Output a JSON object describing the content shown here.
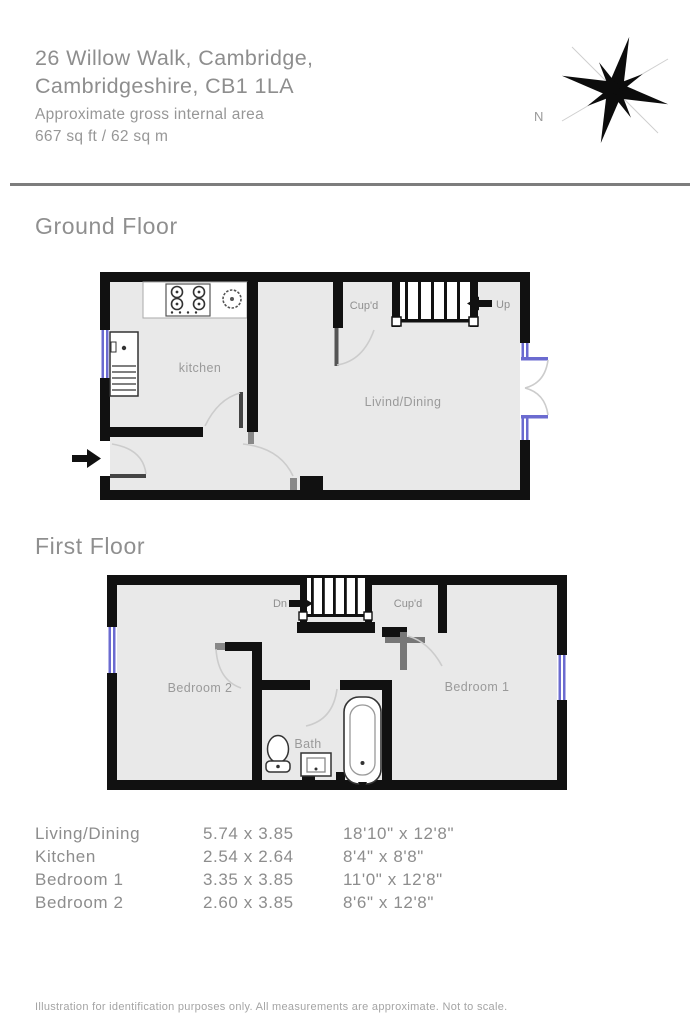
{
  "header": {
    "address_line1": "26 Willow Walk, Cambridge,",
    "address_line2": "Cambridgeshire, CB1 1LA",
    "area_line1": "Approximate gross internal area",
    "area_line2": "667 sq ft / 62 sq m"
  },
  "compass": {
    "north_label": "N"
  },
  "ground_floor": {
    "title": "Ground Floor",
    "labels": {
      "kitchen": "kitchen",
      "living": "Livind/Dining",
      "cupboard": "Cup'd",
      "stairs": "Up"
    }
  },
  "first_floor": {
    "title": "First Floor",
    "labels": {
      "bedroom2": "Bedroom 2",
      "bedroom1": "Bedroom 1",
      "bath": "Bath",
      "cupboard": "Cup'd",
      "stairs": "Dn"
    }
  },
  "dimensions": {
    "rows": [
      {
        "room": "Living/Dining",
        "metric": "5.74 x 3.85",
        "imperial": "18'10\" x 12'8\""
      },
      {
        "room": "Kitchen",
        "metric": "2.54 x 2.64",
        "imperial": "8'4\" x 8'8\""
      },
      {
        "room": "Bedroom 1",
        "metric": "3.35 x 3.85",
        "imperial": "11'0\" x 12'8\""
      },
      {
        "room": "Bedroom 2",
        "metric": "2.60 x 3.85",
        "imperial": "8'6\" x 12'8\""
      }
    ]
  },
  "footer": {
    "disclaimer": "Illustration for identification purposes only. All measurements are approximate. Not to scale."
  },
  "colors": {
    "wall": "#111111",
    "floor": "#e9e9e9",
    "window": "#6b6bd0",
    "text_gray": "#8e8e8e"
  }
}
